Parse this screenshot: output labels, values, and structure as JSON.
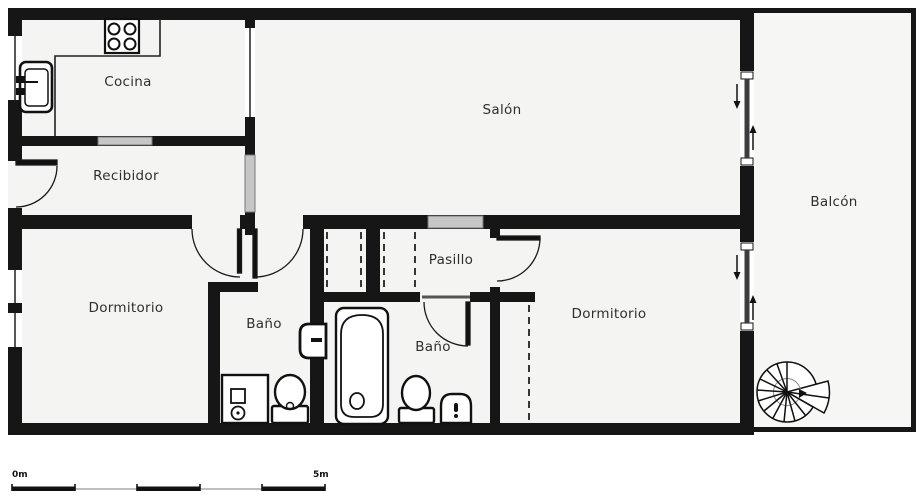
{
  "title": "Apartment floor plan",
  "rooms": {
    "cocina": {
      "label": "Cocina"
    },
    "recibidor": {
      "label": "Recibidor"
    },
    "salon": {
      "label": "Salón"
    },
    "balcon": {
      "label": "Balcón"
    },
    "dormitorio_izquierdo": {
      "label": "Dormitorio"
    },
    "bano_1": {
      "label": "Baño"
    },
    "pasillo": {
      "label": "Pasillo"
    },
    "bano_2": {
      "label": "Baño"
    },
    "dormitorio_derecho": {
      "label": "Dormitorio"
    }
  },
  "scale_bar": {
    "start_label": "0m",
    "end_label": "5m",
    "total_meters": 5,
    "segments": 5
  },
  "fixtures": [
    "stove-icon",
    "kitchen-sink-icon",
    "shower-icon",
    "toilet-icon",
    "wall-sink-icon",
    "bathtub-icon",
    "toilet-icon",
    "pedestal-sink-icon",
    "spiral-staircase-icon",
    "sliding-door-icon",
    "door-swing-icon",
    "wardrobe-dashed-icon"
  ],
  "colors": {
    "wall": "#161616",
    "floor": "#f4f4f2",
    "balcony_floor": "#f6f6f4",
    "glass": "#c6c6c6",
    "slider_panel": "#3c3c3c",
    "label_text": "#2f2f2f",
    "page": "#ffffff"
  }
}
